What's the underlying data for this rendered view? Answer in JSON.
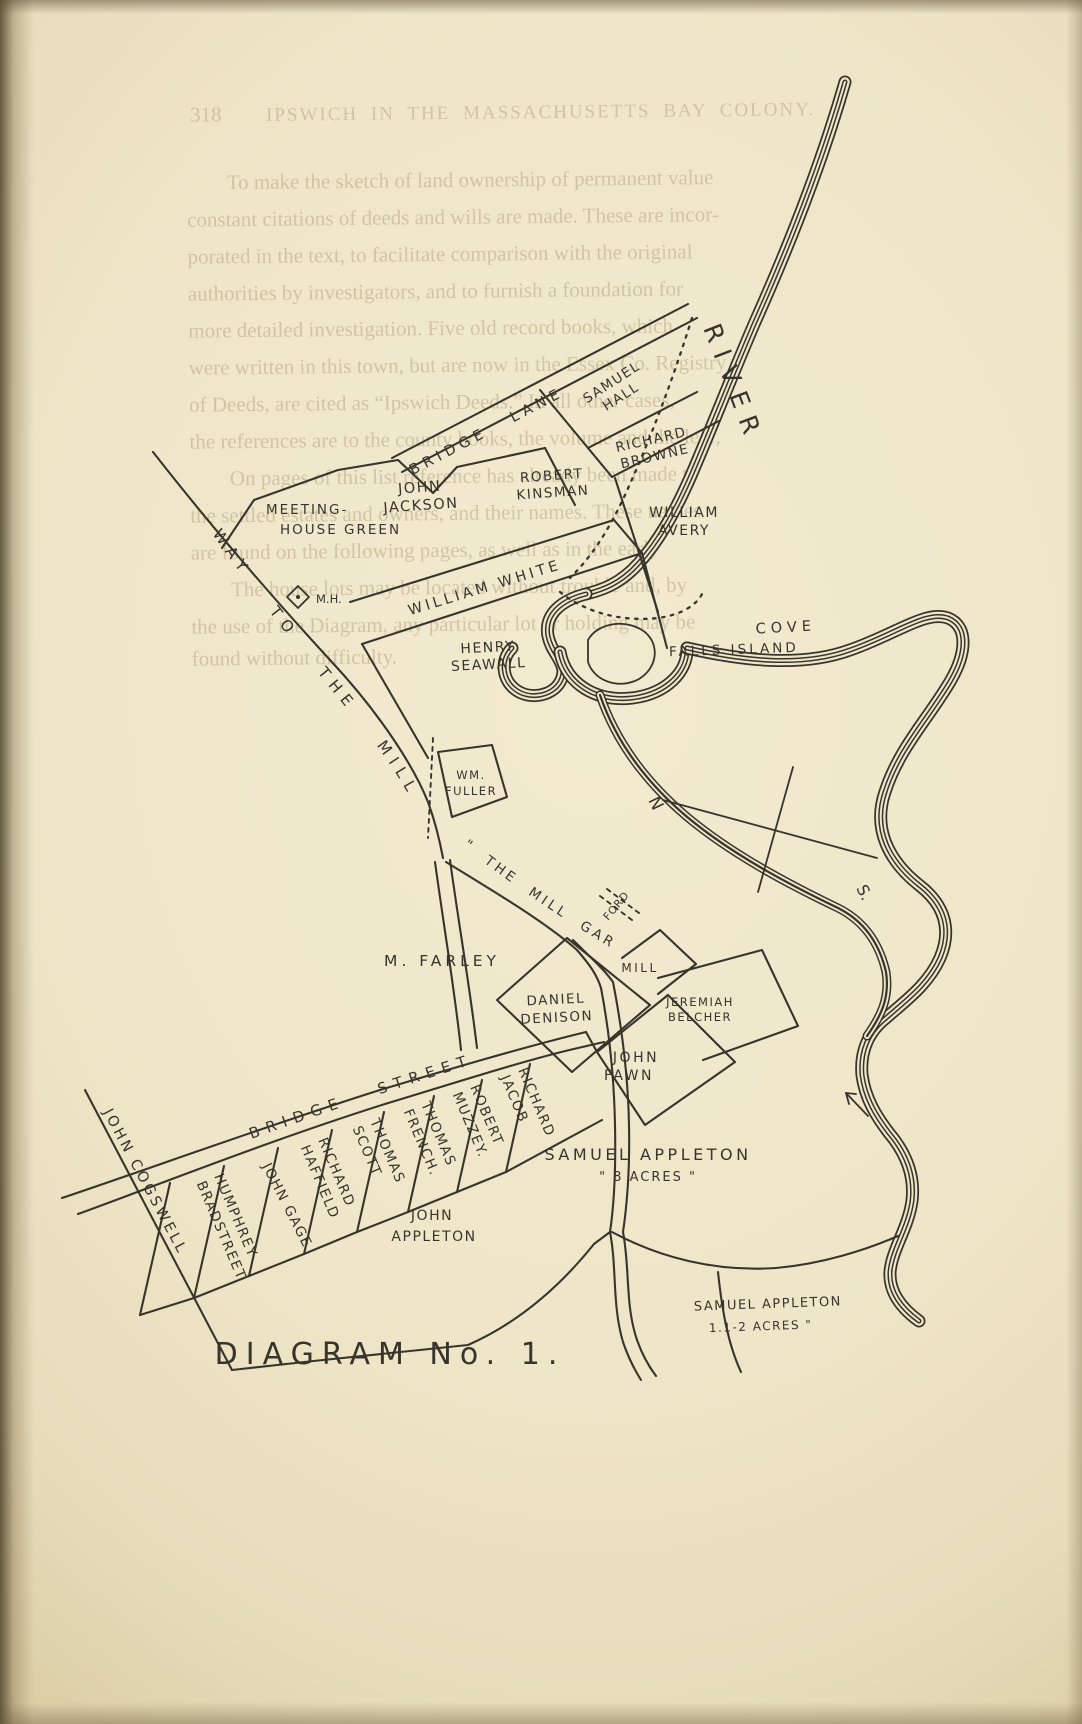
{
  "page": {
    "background": "#efe6c9",
    "ink": "#38342b",
    "ghost_ink": "#a3906a"
  },
  "ghost_text": {
    "page_number": "318",
    "header": "IPSWICH IN THE MASSACHUSETTS BAY COLONY.",
    "lines": [
      "To make the sketch of land ownership of permanent value",
      "constant citations of deeds and wills are made.  These are incor-",
      "porated in the text, to facilitate comparison with the original",
      "authorities by investigators, and to furnish a foundation for",
      "more detailed investigation.  Five old record books, which",
      "were written in this town, but are now in the Essex Co. Registry",
      "of Deeds, are cited as “Ipswich Deeds.”  In all other cases,",
      "the references are to the county books, the volume and the leaf,",
      "On pages of this list reference has already been made to",
      "the settled estates and owners, and their names.  These names",
      "are found on the following pages, as well as in the early",
      "The house lots may be located without trouble and, by",
      "the use of the Diagram, any particular lot or holding may be",
      "found without difficulty."
    ]
  },
  "map": {
    "title": "DIAGRAM  No. 1.",
    "compass": {
      "north": "N",
      "south": "S."
    },
    "water": {
      "river": "RIVER",
      "cove": "COVE",
      "falls_island": "FALLS ISLAND",
      "ford": "FORD",
      "mill": "MILL",
      "mill_garden": "\" THE MILL GARDEN '"
    },
    "roads": {
      "bridge_lane": "BRIDGE LANE",
      "way_to_the_mill": "WAY TO THE MILL",
      "bridge_street": "BRIDGE STREET"
    },
    "meeting_house": {
      "line1": "MEETING-",
      "line2": "HOUSE GREEN",
      "abbr": "M.H."
    },
    "plots": {
      "samuel_hall": {
        "line1": "SAMUEL",
        "line2": "HALL"
      },
      "richard_browne": {
        "line1": "RICHARD",
        "line2": "BROWNE"
      },
      "robert_kinsman": {
        "line1": "ROBERT",
        "line2": "KINSMAN"
      },
      "john_jackson": {
        "line1": "JOHN",
        "line2": "JACKSON"
      },
      "william_avery": {
        "line1": "WILLIAM",
        "line2": "AVERY"
      },
      "william_white": {
        "label": "WILLIAM  WHITE"
      },
      "henry_seawall": {
        "line1": "HENRY",
        "line2": "SEAWALL"
      },
      "wm_fuller": {
        "line1": "WM.",
        "line2": "FULLER"
      },
      "m_farley": {
        "label": "M.  FARLEY"
      },
      "daniel_denison": {
        "line1": "DANIEL",
        "line2": "DENISON"
      },
      "jeremiah_belcher": {
        "line1": "JEREMIAH",
        "line2": "BELCHER"
      },
      "john_fawn": {
        "line1": "JOHN",
        "line2": "FAWN"
      },
      "samuel_appleton_8_acres": {
        "line1": "SAMUEL  APPLETON",
        "line2": "\" 8 ACRES \""
      },
      "john_appleton": {
        "line1": "JOHN",
        "line2": "APPLETON"
      },
      "samuel_appleton_1_1_2_acres": {
        "line1": "SAMUEL APPLETON",
        "line2": "1.1-2 ACRES \""
      },
      "john_cogswell": {
        "label": "JOHN COGSWELL"
      },
      "bridge_street_lots": [
        {
          "line1": "HUMPHREY",
          "line2": "BRADSTREET"
        },
        {
          "line1": "JOHN GAGE",
          "line2": ""
        },
        {
          "line1": "RICHARD",
          "line2": "HAFFIELD"
        },
        {
          "line1": "THOMAS",
          "line2": "SCOTT"
        },
        {
          "line1": "THOMAS",
          "line2": "FRENCH."
        },
        {
          "line1": "ROBERT",
          "line2": "MUZZEY."
        },
        {
          "line1": "RICHARD",
          "line2": "JACOB"
        }
      ]
    }
  }
}
